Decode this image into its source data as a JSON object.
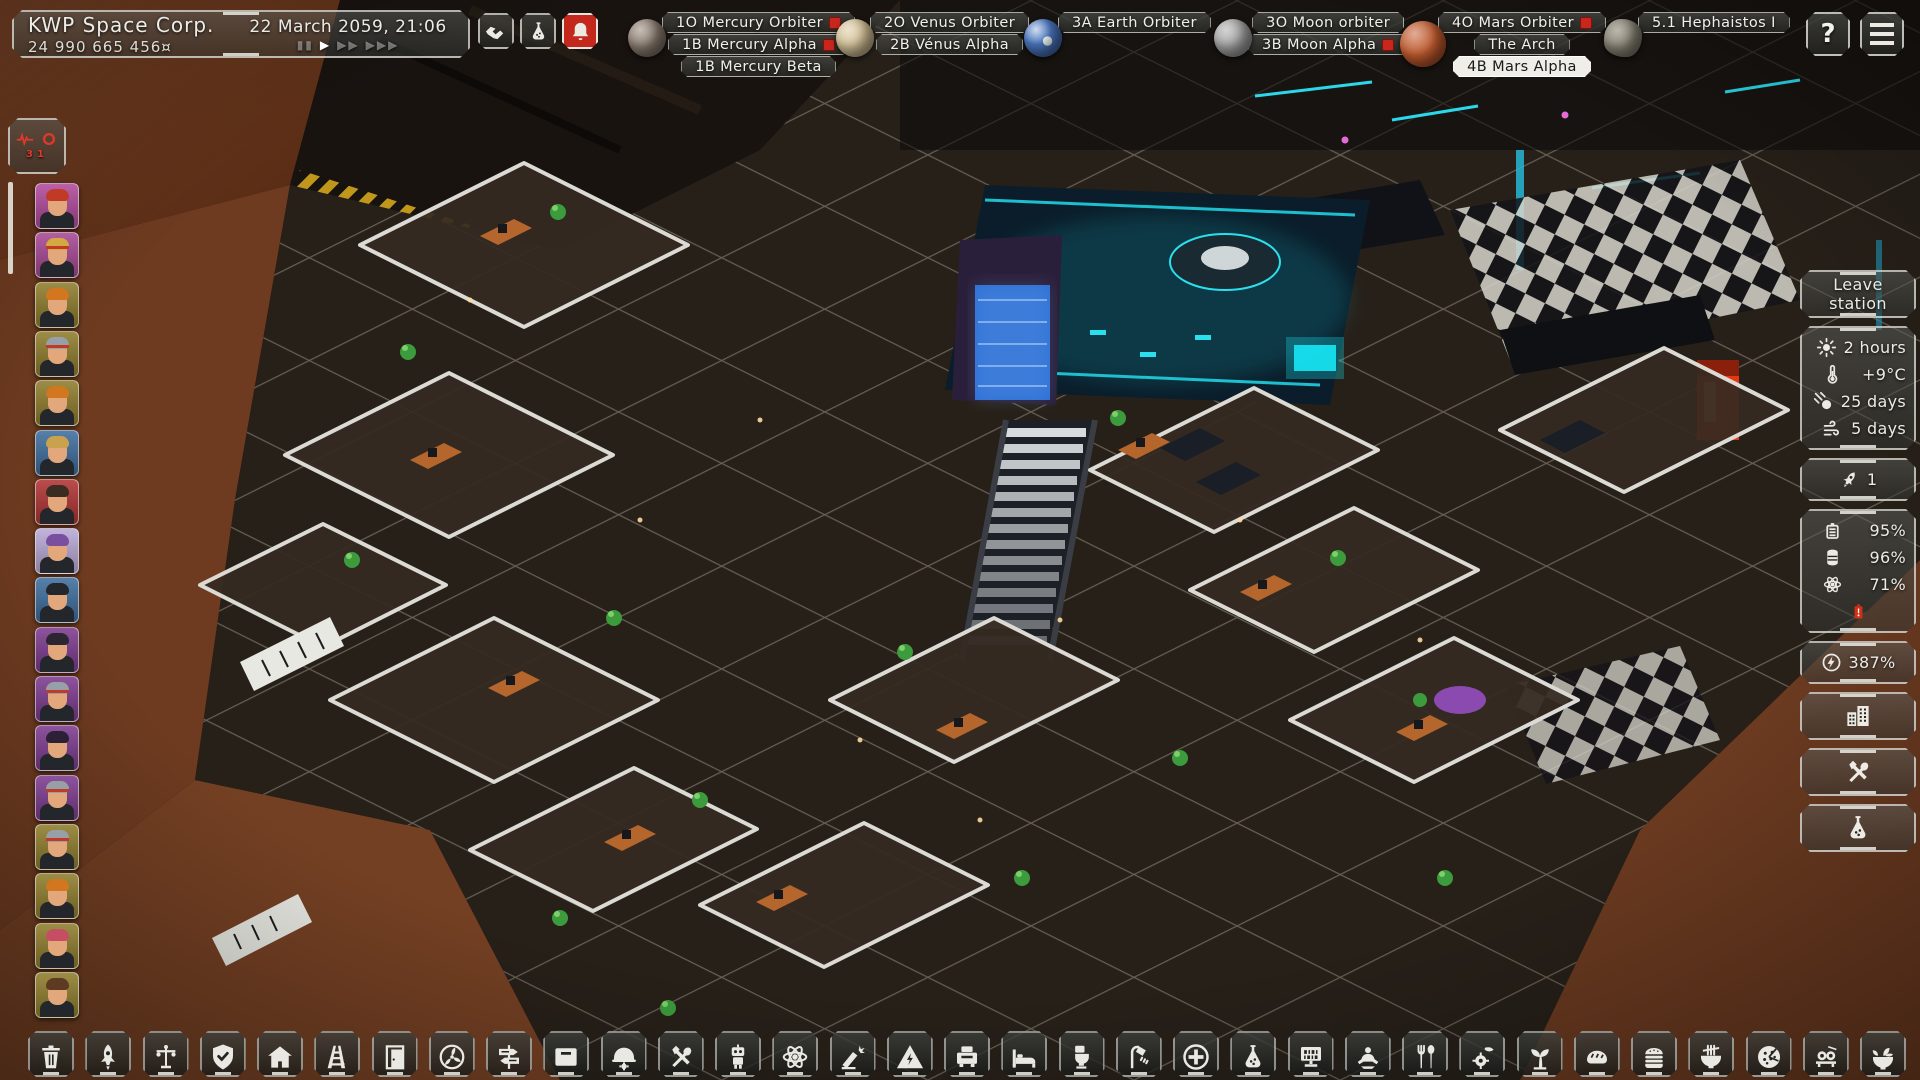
{
  "top_bar": {
    "corp_name": "KWP Space Corp.",
    "funds": "24 990 665 456¤",
    "datetime": "22 March 2059, 21:06",
    "time_controls": [
      "▮▮",
      "▶",
      "▶▶",
      "▶▶▶"
    ],
    "action_buttons": [
      {
        "name": "trade",
        "icon": "handshake-icon"
      },
      {
        "name": "research",
        "icon": "flask-icon"
      },
      {
        "name": "notifications",
        "icon": "bell-icon",
        "alert": true
      }
    ],
    "help_label": "?",
    "nav_groups": [
      {
        "planet": "mercury",
        "color": "#8d7f72",
        "items": [
          {
            "label": "1O Mercury Orbiter",
            "alert": true
          },
          {
            "label": "1B Mercury Alpha",
            "alert": true
          },
          {
            "label": "1B Mercury Beta",
            "alert": false
          }
        ]
      },
      {
        "planet": "venus",
        "color": "#d9c69b",
        "items": [
          {
            "label": "2O Venus Orbiter",
            "alert": false
          },
          {
            "label": "2B Vénus Alpha",
            "alert": false
          }
        ]
      },
      {
        "planet": "earth",
        "color": "#4a78c2",
        "items": [
          {
            "label": "3A Earth Orbiter",
            "alert": false
          }
        ]
      },
      {
        "planet": "moon",
        "color": "#a8a8a8",
        "items": [
          {
            "label": "3O Moon orbiter",
            "alert": false
          },
          {
            "label": "3B Moon Alpha",
            "alert": true
          }
        ]
      },
      {
        "planet": "mars",
        "color": "#c05a2e",
        "items": [
          {
            "label": "4O Mars Orbiter",
            "alert": true
          },
          {
            "label": "The Arch",
            "alert": false
          },
          {
            "label": "4B Mars Alpha",
            "alert": false,
            "selected": true
          }
        ]
      },
      {
        "planet": "asteroid",
        "color": "#8d8778",
        "items": [
          {
            "label": "5.1 Hephaistos I",
            "alert": false
          }
        ]
      }
    ]
  },
  "crew_sidebar": {
    "alert_values": [
      "3",
      "1"
    ],
    "crew": [
      {
        "bg": "#b14a9c",
        "hair": "#c03a26"
      },
      {
        "bg": "#a84895",
        "hair": "#d4a843",
        "band": true
      },
      {
        "bg": "#8f7d2c",
        "hair": "#d2761f"
      },
      {
        "bg": "#8f7d2c",
        "hair": "#97a0a8",
        "band": true
      },
      {
        "bg": "#8f7d2c",
        "hair": "#d2761f"
      },
      {
        "bg": "#3f6e9e",
        "hair": "#caa24e"
      },
      {
        "bg": "#b13434",
        "hair": "#3a2c20"
      },
      {
        "bg": "#b9a9d6",
        "hair": "#7b4fa0"
      },
      {
        "bg": "#3f6e9e",
        "hair": "#23272b"
      },
      {
        "bg": "#7e3b90",
        "hair": "#2c2633"
      },
      {
        "bg": "#7e3b90",
        "hair": "#97a0a8",
        "band": true
      },
      {
        "bg": "#7e3b90",
        "hair": "#2a2136"
      },
      {
        "bg": "#7e3b90",
        "hair": "#97a0a8",
        "band": true
      },
      {
        "bg": "#8f7d2c",
        "hair": "#97a0a8",
        "band": true
      },
      {
        "bg": "#8f7d2c",
        "hair": "#d2761f"
      },
      {
        "bg": "#8f7d2c",
        "hair": "#c64e62"
      },
      {
        "bg": "#8f7d2c",
        "hair": "#5d3a22"
      }
    ]
  },
  "right_panel": {
    "leave_station_label": "Leave station",
    "environment": [
      {
        "icon": "sun-icon",
        "value": "2 hours"
      },
      {
        "icon": "thermometer-icon",
        "value": "+9°C"
      },
      {
        "icon": "meteor-icon",
        "value": "25 days"
      },
      {
        "icon": "dust-storm-icon",
        "value": "5 days"
      }
    ],
    "rockets": {
      "icon": "rocket-icon",
      "value": "1"
    },
    "resources": [
      {
        "icon": "battery-icon",
        "value": "95%"
      },
      {
        "icon": "water-tank-icon",
        "value": "96%"
      },
      {
        "icon": "reactor-icon",
        "value": "71%"
      }
    ],
    "resource_alert_icon": "battery-low-icon",
    "power": {
      "icon": "energy-icon",
      "value": "387%"
    },
    "side_buttons": [
      "buildings",
      "construction",
      "research"
    ]
  },
  "build_toolbar": {
    "items": [
      "demolish",
      "rocket",
      "street-lamp",
      "security",
      "habitat",
      "tracks",
      "door",
      "airlock",
      "signpost",
      "storage",
      "engineering",
      "workshop",
      "robotics",
      "reactor",
      "fabrication",
      "power",
      "printer",
      "bedroom",
      "toilet",
      "shower",
      "medbay",
      "laboratory",
      "computers",
      "wellness",
      "dining",
      "food-processing",
      "greenhouse",
      "bakery",
      "burger-bar",
      "noodle-bar",
      "pizzeria",
      "sushi-bar",
      "salad-bar"
    ]
  }
}
